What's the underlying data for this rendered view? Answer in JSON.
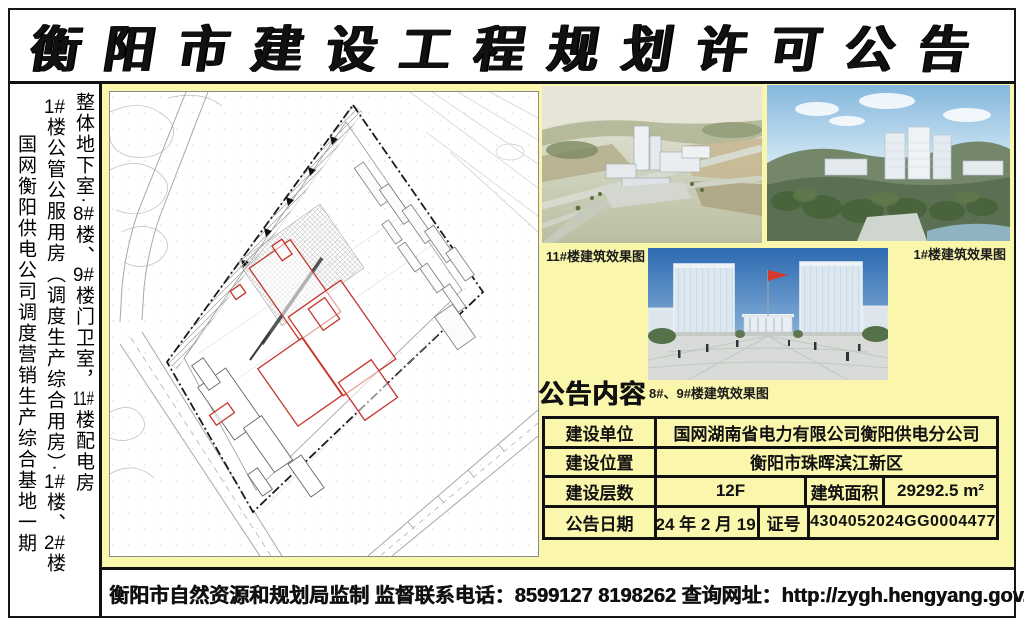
{
  "page": {
    "title": "衡阳市建设工程规划许可公告",
    "footer": "衡阳市自然资源和规划局监制 监督联系电话：8599127  8198262  查询网址：http://zygh.hengyang.gov.cn"
  },
  "project_name": {
    "line1_segments": [
      {
        "t": "国网衡阳供电公司调度营销生产综合基地一期"
      }
    ],
    "line2_segments": [
      {
        "t": "1#",
        "combine": true
      },
      {
        "t": "楼公管公服用房（调度生产综合用房）·"
      },
      {
        "t": "1#",
        "combine": true
      },
      {
        "t": "楼、"
      },
      {
        "t": "2#",
        "combine": true
      },
      {
        "t": "楼"
      }
    ],
    "line3_segments": [
      {
        "t": "整体地下室·"
      },
      {
        "t": "8#",
        "combine": true
      },
      {
        "t": "楼、"
      },
      {
        "t": "9#",
        "combine": true
      },
      {
        "t": "楼门卫室，"
      },
      {
        "t": "11#",
        "combine": true
      },
      {
        "t": "楼配电房"
      }
    ]
  },
  "renderings": {
    "caption_11": "11#楼建筑效果图",
    "caption_1": "1#楼建筑效果图",
    "caption_8_9": "8#、9#楼建筑效果图"
  },
  "announcement": {
    "heading": "公告内容",
    "table": {
      "rows": [
        [
          "建设单位",
          "国网湖南省电力有限公司衡阳供电分公司"
        ],
        [
          "建设位置",
          "衡阳市珠晖滨江新区"
        ],
        [
          "建设层数",
          "12F",
          "建筑面积",
          "29292.5 m²"
        ],
        [
          "公告日期",
          "2024 年 2 月 19 日",
          "证号",
          "4304052024GG0004477"
        ]
      ]
    }
  },
  "colors": {
    "background_yellow": "#FAF6AC",
    "building_outline_red": "#C5352C",
    "frame_black": "#161616"
  }
}
